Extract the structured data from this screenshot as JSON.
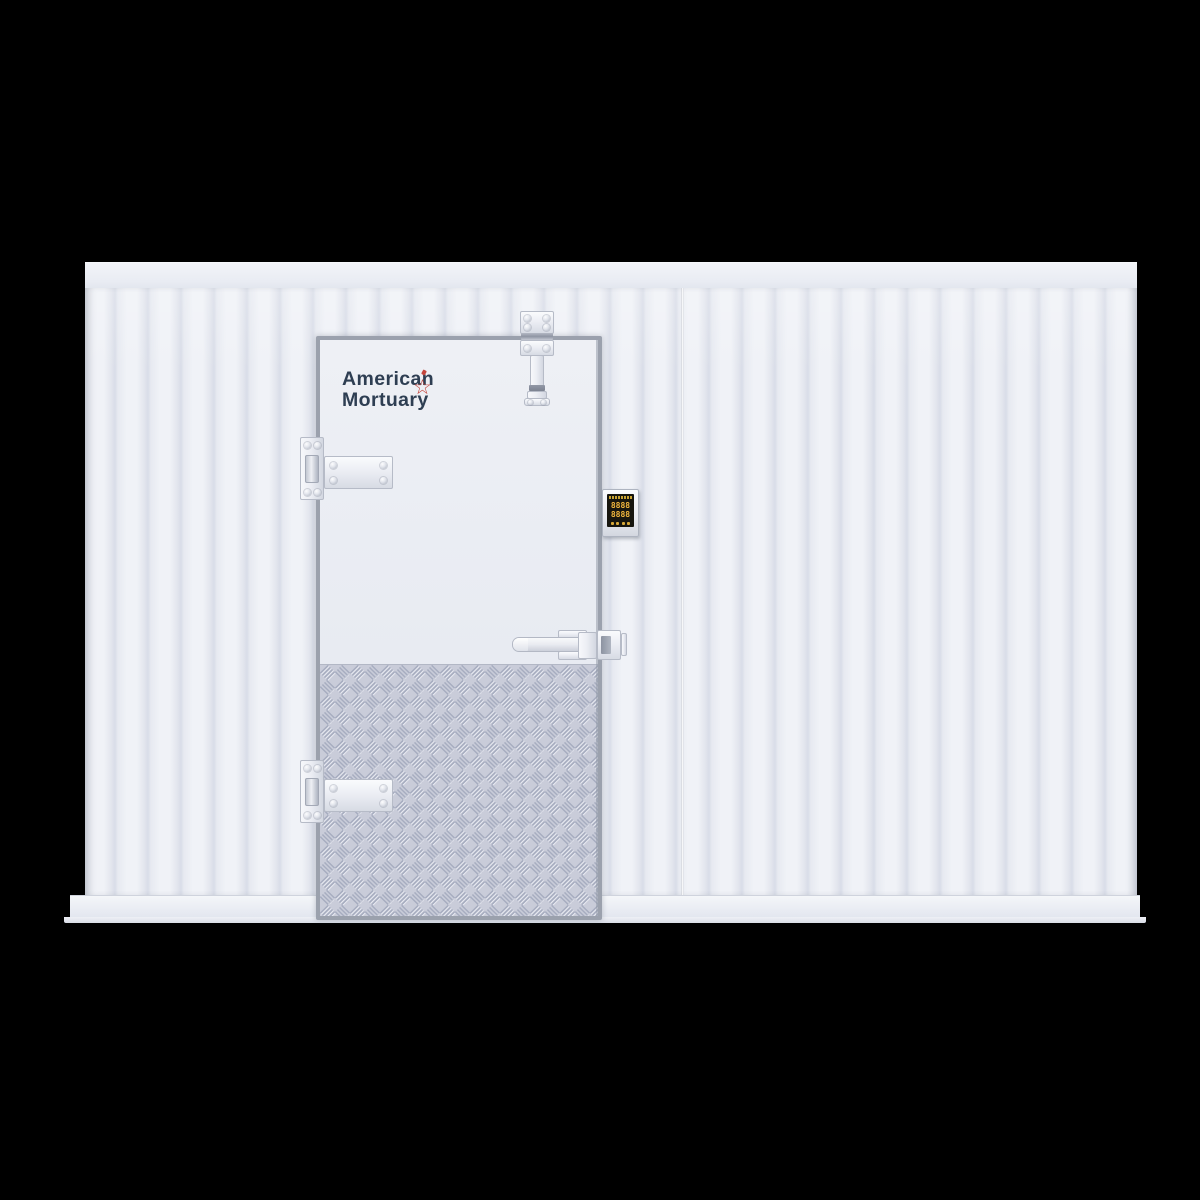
{
  "scene": {
    "background_color": "#000000"
  },
  "logo": {
    "line1": "American",
    "line2": "Mortuary",
    "star_glyph": "☆",
    "text_color": "#2e3e52",
    "accent_color": "#c4453c"
  },
  "controller": {
    "display_row1": "8888",
    "display_row2": "8888",
    "digit_color": "#f2b73e",
    "screen_color": "#17160f",
    "button_count": 4
  },
  "colors": {
    "wall_panel": "#e9ecf3",
    "rib_shadow": "#d9dde8",
    "cap_rail": "#eceef4",
    "base_rail": "#eaedf3",
    "door_frame": "#9ba1ad",
    "door_face": "#e8ebf2",
    "tread_base": "#c9ccd9",
    "tread_dark": "#a7adc0",
    "tread_light": "#eaecf3",
    "hardware": "#eceef4",
    "hardware_edge": "#b6bbc7"
  }
}
